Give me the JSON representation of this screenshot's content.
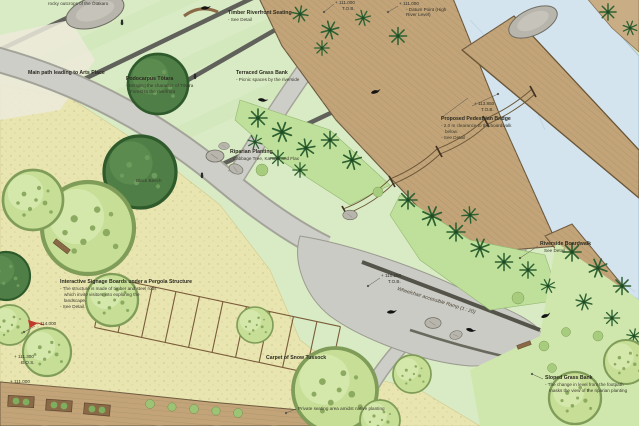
{
  "colors": {
    "lawn_green": "#d9ebc4",
    "tussock_yellow": "#e9e5b0",
    "riparian_green": "#bfe09a",
    "path_gray": "#cbcbc5",
    "terrace_gray": "#5f615a",
    "boardwalk_tan": "#c2a478",
    "timber_brown": "#7a5c3a",
    "water_blue": "#d3e4ee",
    "canopy_light": "#c6de96",
    "canopy_dark": "#4f7f46",
    "annotation_ink": "#3a392e",
    "marker_red": "#c0392b"
  },
  "annotations": {
    "rocky_outcrops": "rocky outcrops of the Ōtākaro",
    "main_path": "Main path leading to Arts Place",
    "totara": {
      "title": "Podocarpus Tōtara",
      "line1": "- Bringing the character of Tōtara",
      "line2": "Forest to the riverfront"
    },
    "terraced_bank": {
      "title": "Terraced Grass Bank",
      "line1": "- Picnic spaces by the riverside"
    },
    "timber_seating": {
      "title": "Timber Riverfront Seating",
      "line1": "- See Detail"
    },
    "pedestrian_bridge": {
      "title": "Proposed Pedestrian Bridge",
      "line1": "- 2.0 m clearance to the boardwalk",
      "line2": "below.",
      "line3": "- See Detail"
    },
    "riparian_planting": {
      "title": "Riparian Planting",
      "line1": "- Cabbage Tree, Kanuka and Flax"
    },
    "black_beech": "Black Beech",
    "riverside_boardwalk": {
      "title": "Riverside Boardwalk",
      "line1": "See Detail"
    },
    "ramp": "Wheelchair accessible Ramp (1 : 20)",
    "pergola": {
      "title": "Interactive Signage Boards under a Pergola Structure",
      "line1": "- The structure is made of timber and steel rods",
      "line2": "which invite visitors into exploring the",
      "line3": "landscape.",
      "line4": "- See Detail."
    },
    "snow_tussock": "Carpet of Snow Tussock",
    "sloped_bank": {
      "title": "Sloped Grass Bank",
      "line1": "- The change in level from the footpath",
      "line2": "masks the view of the riparian planting"
    },
    "private_seating": "Private seating area amidst native planting"
  },
  "levels": {
    "bank_top": {
      "value": "+ 111.000",
      "ref": "T.O.B."
    },
    "datum": {
      "value": "+ 111.000",
      "line1": "- Datum Point (High",
      "line2": "River Level)"
    },
    "bridge": {
      "value": "+ 113.850",
      "ref": "T.O.B."
    },
    "ramp": {
      "value": "+ 110.250",
      "ref": "T.O.B."
    },
    "upper_lawn": {
      "value": "+ 114.000"
    },
    "steps": {
      "value": "+ 111.300",
      "ref": "B.O.S."
    },
    "lower_path": {
      "value": "+ 111.000"
    }
  }
}
